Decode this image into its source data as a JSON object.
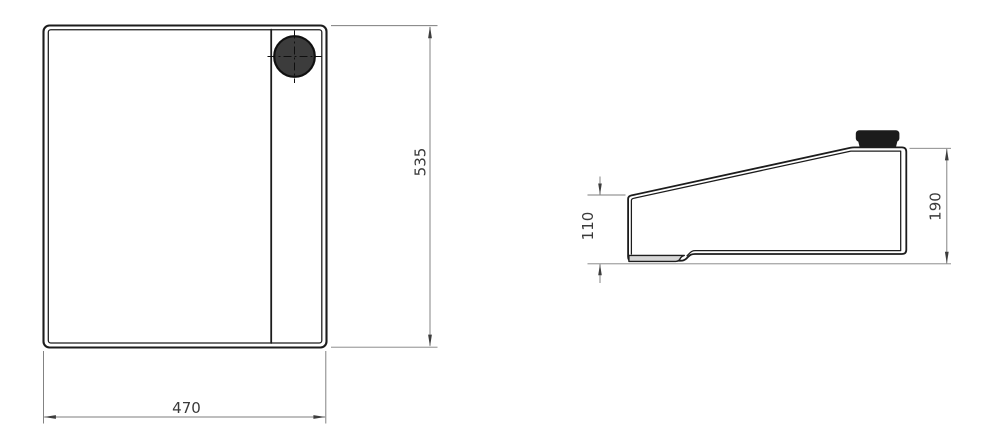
{
  "drawing": {
    "type": "technical-drawing-two-views",
    "views": {
      "front": {
        "name": "front-view",
        "width_dim_label": "470",
        "height_dim_label": "535"
      },
      "side": {
        "name": "side-view",
        "left_height_dim_label": "110",
        "right_height_dim_label": "190"
      }
    },
    "colors": {
      "background": "#ffffff",
      "outline": "#1c1c1c",
      "dimension_line": "#7d7d7d",
      "arrow": "#3d3d3d",
      "dimension_text": "#3a3a3a",
      "cap_fill_side": "#1b1b1b",
      "cap_fill_front": "#3c3c3c",
      "foot_fill": "#d6d6d6"
    }
  }
}
